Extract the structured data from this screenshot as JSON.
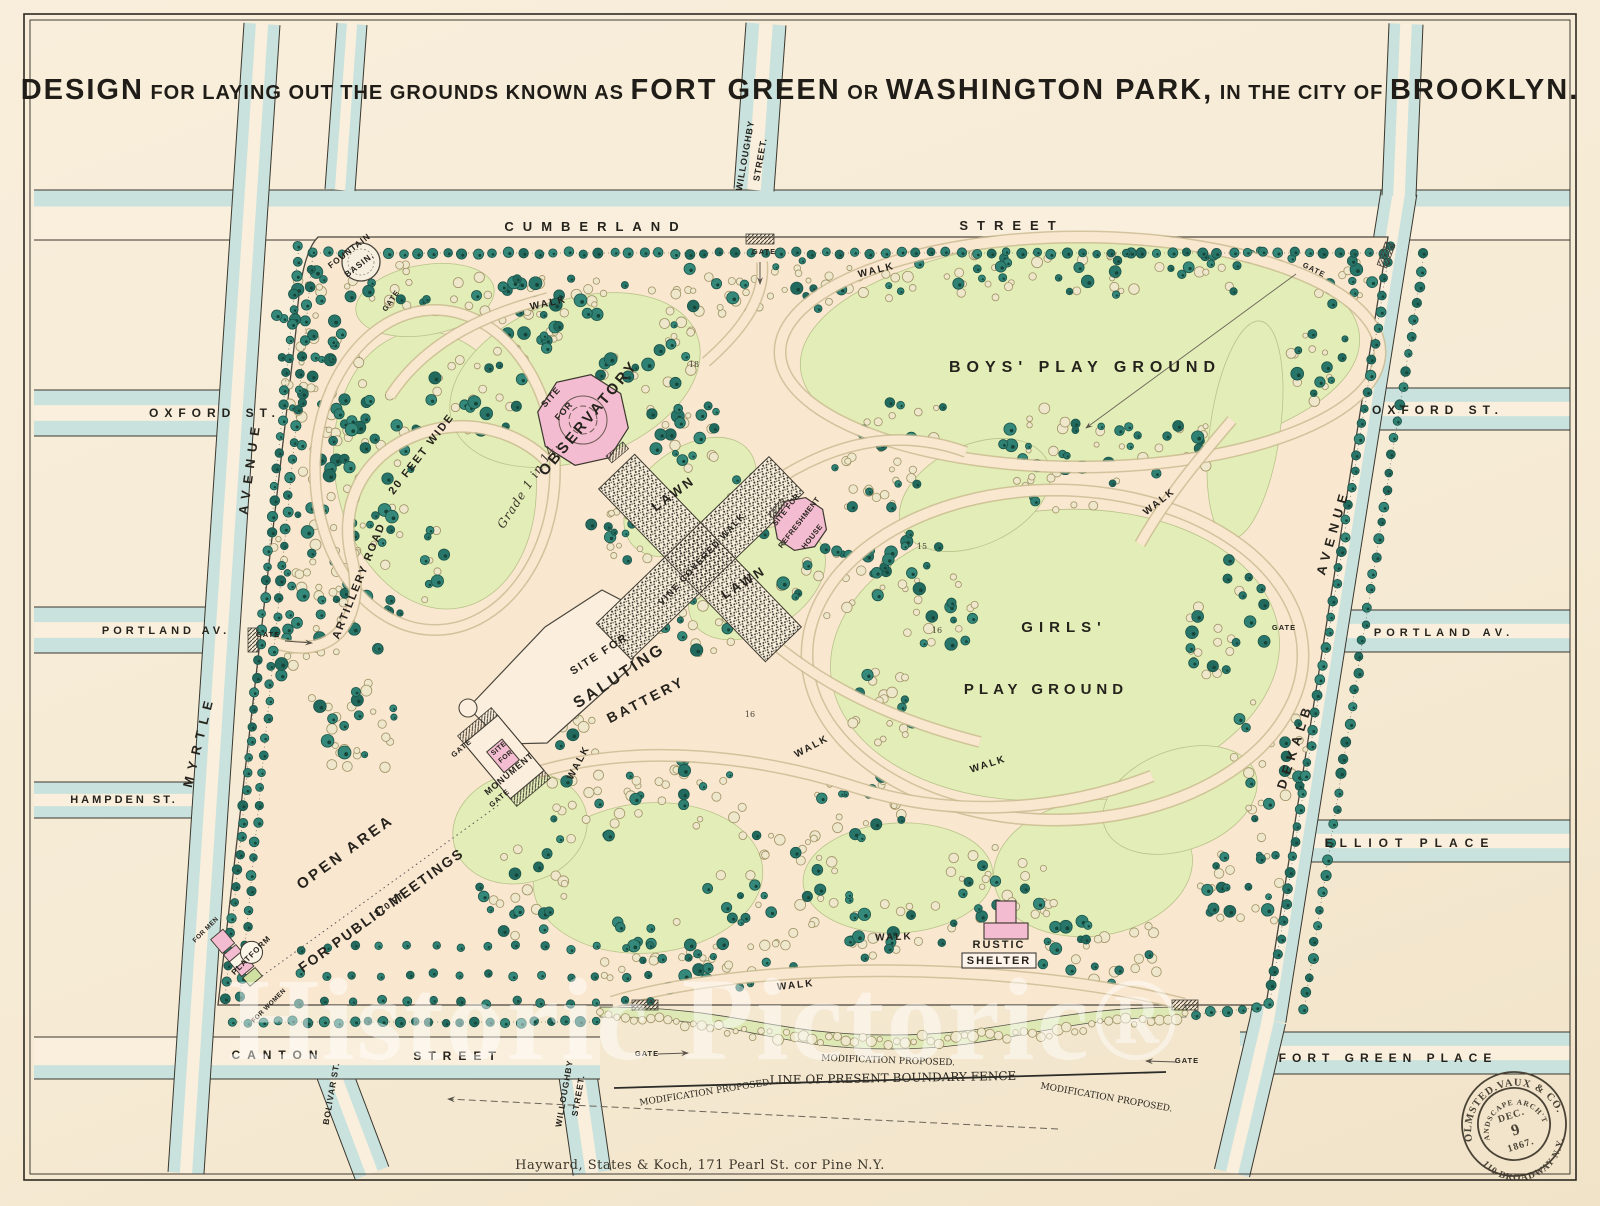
{
  "title": {
    "segments": [
      {
        "t": "DESIGN",
        "s": "lg"
      },
      {
        "t": " FOR LAYING OUT THE GROUNDS KNOWN AS ",
        "s": "md"
      },
      {
        "t": "FORT GREEN",
        "s": "lg"
      },
      {
        "t": " OR ",
        "s": "md"
      },
      {
        "t": "WASHINGTON PARK,",
        "s": "lg"
      },
      {
        "t": " IN THE CITY OF ",
        "s": "md"
      },
      {
        "t": "BROOKLYN.",
        "s": "lg"
      }
    ]
  },
  "map": {
    "street_labels": [
      {
        "id": "cumberland",
        "label": "CUMBERLAND",
        "x": 596,
        "y": 231,
        "r": 0,
        "fs": 13,
        "ls": 9
      },
      {
        "id": "cumberland-street",
        "label": "STREET",
        "x": 1012,
        "y": 230,
        "r": 0,
        "fs": 13,
        "ls": 9
      },
      {
        "id": "willoughby-top-1",
        "label": "WILLOUGHBY",
        "x": 748,
        "y": 156,
        "r": -80,
        "fs": 9,
        "ls": 1
      },
      {
        "id": "willoughby-top-2",
        "label": "STREET.",
        "x": 763,
        "y": 160,
        "r": -80,
        "fs": 9,
        "ls": 1
      },
      {
        "id": "oxford-left",
        "label": "OXFORD ST.",
        "x": 215,
        "y": 417,
        "r": 0,
        "fs": 12,
        "ls": 6
      },
      {
        "id": "oxford-right",
        "label": "OXFORD ST.",
        "x": 1438,
        "y": 414,
        "r": 0,
        "fs": 12,
        "ls": 6
      },
      {
        "id": "portland-left",
        "label": "PORTLAND AV.",
        "x": 166,
        "y": 634,
        "r": 0,
        "fs": 11,
        "ls": 4
      },
      {
        "id": "portland-right",
        "label": "PORTLAND AV.",
        "x": 1444,
        "y": 636,
        "r": 0,
        "fs": 11,
        "ls": 5
      },
      {
        "id": "myrtle",
        "label": "MYRTLE",
        "x": 203,
        "y": 742,
        "r": -76,
        "fs": 13,
        "ls": 7
      },
      {
        "id": "myrtle-avenue",
        "label": "AVENUE",
        "x": 254,
        "y": 468,
        "r": -82,
        "fs": 13,
        "ls": 7
      },
      {
        "id": "hampden",
        "label": "HAMPDEN ST.",
        "x": 124,
        "y": 803,
        "r": 0,
        "fs": 11,
        "ls": 3
      },
      {
        "id": "canton",
        "label": "CANTON",
        "x": 278,
        "y": 1059,
        "r": 0,
        "fs": 12,
        "ls": 7
      },
      {
        "id": "canton-street",
        "label": "STREET",
        "x": 458,
        "y": 1060,
        "r": 0,
        "fs": 12,
        "ls": 7
      },
      {
        "id": "bolivar",
        "label": "BOLIVAR ST.",
        "x": 334,
        "y": 1094,
        "r": -80,
        "fs": 8.5,
        "ls": 1
      },
      {
        "id": "willoughby-bottom-1",
        "label": "WILLOUGHBY",
        "x": 567,
        "y": 1094,
        "r": -80,
        "fs": 8.5,
        "ls": 1
      },
      {
        "id": "willoughby-bottom-2",
        "label": "STREET.",
        "x": 581,
        "y": 1096,
        "r": -80,
        "fs": 8.5,
        "ls": 1
      },
      {
        "id": "dekalb",
        "label": "DEKALB",
        "x": 1299,
        "y": 747,
        "r": -72,
        "fs": 13,
        "ls": 6
      },
      {
        "id": "dekalb-avenue",
        "label": "AVENUE",
        "x": 1337,
        "y": 533,
        "r": -74,
        "fs": 13,
        "ls": 6
      },
      {
        "id": "elliot",
        "label": "ELLIOT PLACE",
        "x": 1410,
        "y": 847,
        "r": 0,
        "fs": 12,
        "ls": 7
      },
      {
        "id": "fort-green",
        "label": "FORT GREEN PLACE",
        "x": 1388,
        "y": 1062,
        "r": 0,
        "fs": 12,
        "ls": 6
      }
    ],
    "feature_labels": [
      {
        "id": "fountain-1",
        "label": "FOUNTAIN",
        "x": 351,
        "y": 253,
        "r": -38,
        "fs": 8.5,
        "ls": 1
      },
      {
        "id": "fountain-2",
        "label": "BASIN.",
        "x": 361,
        "y": 267,
        "r": -38,
        "fs": 8.5,
        "ls": 1
      },
      {
        "id": "artillery-road",
        "label": "ARTILLERY ROAD",
        "x": 362,
        "y": 582,
        "r": -68,
        "fs": 11,
        "ls": 2
      },
      {
        "id": "artillery-road-2",
        "label": "20 FEET WIDE",
        "x": 424,
        "y": 456,
        "r": -52,
        "fs": 11,
        "ls": 2
      },
      {
        "id": "grade",
        "label": "Grade 1 in 14.",
        "x": 531,
        "y": 487,
        "r": -57,
        "fs": 12,
        "ls": 1,
        "serif": true
      },
      {
        "id": "observatory-site-1",
        "label": "SITE",
        "x": 553,
        "y": 399,
        "r": -48,
        "fs": 9,
        "ls": 1
      },
      {
        "id": "observatory-site-2",
        "label": "FOR",
        "x": 566,
        "y": 413,
        "r": -48,
        "fs": 9,
        "ls": 1
      },
      {
        "id": "observatory",
        "label": "OBSERVATORY",
        "x": 592,
        "y": 421,
        "r": -50,
        "fs": 15,
        "ls": 3
      },
      {
        "id": "lawn-1",
        "label": "LAWN",
        "x": 676,
        "y": 497,
        "r": -36,
        "fs": 13,
        "ls": 3
      },
      {
        "id": "lawn-2",
        "label": "LAWN",
        "x": 746,
        "y": 586,
        "r": -32,
        "fs": 13,
        "ls": 3
      },
      {
        "id": "vine-walk",
        "label": "VINE COVERED WALK",
        "x": 704,
        "y": 561,
        "r": -47,
        "fs": 9,
        "ls": 1.5
      },
      {
        "id": "refresh-1",
        "label": "SITE FOR",
        "x": 788,
        "y": 511,
        "r": -52,
        "fs": 7.5,
        "ls": 0.5
      },
      {
        "id": "refresh-2",
        "label": "REFRESHMENT",
        "x": 801,
        "y": 524,
        "r": -52,
        "fs": 7.5,
        "ls": 0.5
      },
      {
        "id": "refresh-3",
        "label": "HOUSE",
        "x": 814,
        "y": 538,
        "r": -52,
        "fs": 7.5,
        "ls": 0.5
      },
      {
        "id": "battery-1",
        "label": "SITE FOR",
        "x": 601,
        "y": 657,
        "r": -33,
        "fs": 11,
        "ls": 2
      },
      {
        "id": "battery-2",
        "label": "SALUTING",
        "x": 622,
        "y": 680,
        "r": -33,
        "fs": 16,
        "ls": 3
      },
      {
        "id": "battery-3",
        "label": "BATTERY",
        "x": 648,
        "y": 704,
        "r": -27,
        "fs": 14,
        "ls": 3
      },
      {
        "id": "boys-playground",
        "label": "BOYS'  PLAY  GROUND",
        "x": 1085,
        "y": 372,
        "r": 0,
        "fs": 16,
        "ls": 6
      },
      {
        "id": "girls-1",
        "label": "GIRLS'",
        "x": 1064,
        "y": 632,
        "r": 0,
        "fs": 15,
        "ls": 6
      },
      {
        "id": "girls-2",
        "label": "PLAY GROUND",
        "x": 1046,
        "y": 694,
        "r": 0,
        "fs": 15,
        "ls": 5
      },
      {
        "id": "open-area-1",
        "label": "OPEN  AREA",
        "x": 348,
        "y": 856,
        "r": -36,
        "fs": 15,
        "ls": 3
      },
      {
        "id": "open-area-2",
        "label": "FOR  PUBLIC  MEETINGS",
        "x": 384,
        "y": 914,
        "r": -36,
        "fs": 14,
        "ls": 2
      },
      {
        "id": "dist-370",
        "label": "370 FT.",
        "x": 392,
        "y": 906,
        "r": -36,
        "fs": 9,
        "ls": 1
      },
      {
        "id": "platform",
        "label": "PLATFORM",
        "x": 253,
        "y": 957,
        "r": -45,
        "fs": 8,
        "ls": 1
      },
      {
        "id": "for-men",
        "label": "FOR MEN",
        "x": 207,
        "y": 931,
        "r": -45,
        "fs": 6.5,
        "ls": 0.5
      },
      {
        "id": "for-women",
        "label": "FOR WOMEN",
        "x": 270,
        "y": 1007,
        "r": -45,
        "fs": 6.5,
        "ls": 0.5
      },
      {
        "id": "monument-1",
        "label": "SITE",
        "x": 500,
        "y": 750,
        "r": -40,
        "fs": 7,
        "ls": 0.5
      },
      {
        "id": "monument-2",
        "label": "FOR",
        "x": 507,
        "y": 758,
        "r": -40,
        "fs": 7,
        "ls": 0.5
      },
      {
        "id": "monument-3",
        "label": "MONUMENT",
        "x": 511,
        "y": 776,
        "r": -40,
        "fs": 9,
        "ls": 1
      },
      {
        "id": "rustic",
        "label": "RUSTIC",
        "x": 999,
        "y": 948,
        "r": 0,
        "fs": 11,
        "ls": 2
      },
      {
        "id": "shelter",
        "label": "SHELTER",
        "x": 999,
        "y": 964,
        "r": 0,
        "fs": 11,
        "ls": 2
      }
    ],
    "walk_label": "WALK",
    "walks": [
      {
        "x": 549,
        "y": 306,
        "r": -12
      },
      {
        "x": 877,
        "y": 273,
        "r": -14
      },
      {
        "x": 1161,
        "y": 504,
        "r": -38
      },
      {
        "x": 581,
        "y": 764,
        "r": -62
      },
      {
        "x": 813,
        "y": 749,
        "r": -28
      },
      {
        "x": 989,
        "y": 767,
        "r": -18
      },
      {
        "x": 894,
        "y": 940,
        "r": -2
      },
      {
        "x": 796,
        "y": 988,
        "r": -6
      }
    ],
    "gate_label": "GATE",
    "gates": [
      {
        "x": 764,
        "y": 254,
        "r": 0
      },
      {
        "x": 393,
        "y": 302,
        "r": -55
      },
      {
        "x": 1313,
        "y": 272,
        "r": 26
      },
      {
        "x": 268,
        "y": 637,
        "r": 0
      },
      {
        "x": 463,
        "y": 750,
        "r": -40
      },
      {
        "x": 501,
        "y": 800,
        "r": -40
      },
      {
        "x": 647,
        "y": 1056,
        "r": 0
      },
      {
        "x": 1187,
        "y": 1063,
        "r": 0
      },
      {
        "x": 1284,
        "y": 630,
        "r": 0
      }
    ],
    "contour_labels": [
      {
        "label": "18",
        "x": 694,
        "y": 367
      },
      {
        "label": "15",
        "x": 922,
        "y": 549
      },
      {
        "label": "16",
        "x": 937,
        "y": 633
      },
      {
        "label": "16",
        "x": 750,
        "y": 717
      }
    ],
    "fence_labels": [
      {
        "id": "mod-left",
        "label": "MODIFICATION PROPOSED.",
        "x": 706,
        "y": 1095,
        "r": -9,
        "fs": 9
      },
      {
        "id": "mod-center",
        "label": "MODIFICATION  PROPOSED.",
        "x": 888,
        "y": 1063,
        "r": 2,
        "fs": 9
      },
      {
        "id": "fence-line",
        "label": "LINE OF PRESENT BOUNDARY FENCE",
        "x": 893,
        "y": 1082,
        "r": -1,
        "fs": 12,
        "b": true
      },
      {
        "id": "mod-right",
        "label": "MODIFICATION PROPOSED.",
        "x": 1106,
        "y": 1100,
        "r": 10,
        "fs": 9
      }
    ]
  },
  "stamp": {
    "name": "OLMSTED.VAUX & CO.",
    "assoc": "LANDSCAPE ARCH'TS",
    "month": "DEC.",
    "day": "9",
    "year": "1867.",
    "address": "110 BROADWAY N.Y."
  },
  "watermark": "Historic Pictoric®",
  "imprint": "Hayward, States & Koch, 171 Pearl St. cor Pine N.Y.",
  "colors": {
    "paper": "#f6ecd8",
    "street_water": "#c6e1dc",
    "park_path": "#f9e7d0",
    "lawn": "#e3edb7",
    "tree_dark": "#2f8173",
    "site_pink": "#f4bcd0",
    "ink": "#26231d"
  }
}
